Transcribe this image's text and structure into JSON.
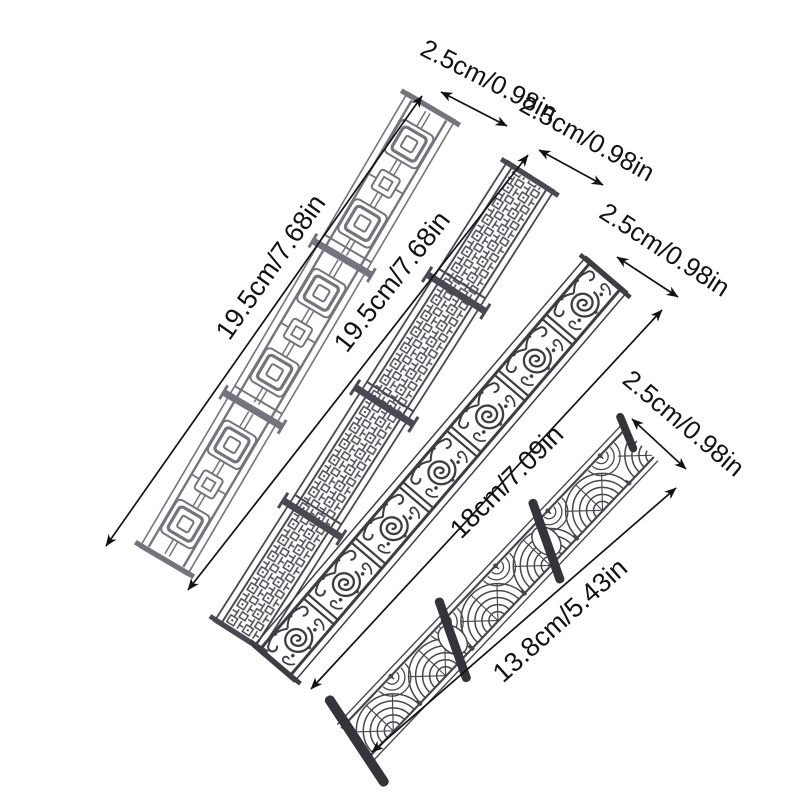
{
  "figure": {
    "type": "product-dimension-diagram",
    "background_color": "#ffffff",
    "annotation": {
      "color": "#121212"
    },
    "strips": [
      {
        "name": "fence-style-1",
        "pattern": "concentric-square lattice railing",
        "length_label": "19.5cm/7.68in",
        "width_label": "2.5cm/0.98in",
        "color": "#76737e"
      },
      {
        "name": "fence-style-2",
        "pattern": "dense fretwork lattice railing",
        "length_label": "19.5cm/7.68in",
        "width_label": "2.5cm/0.98in",
        "color": "#4a4852"
      },
      {
        "name": "fence-style-3",
        "pattern": "scroll wrought-iron railing",
        "length_label": "18cm/7.09in",
        "width_label": "2.5cm/0.98in",
        "color": "#3e3c44"
      },
      {
        "name": "fence-style-4",
        "pattern": "fan arc railing",
        "length_label": "13.8cm/5.43in",
        "width_label": "2.5cm/0.98in",
        "color": "#47454d",
        "post_color": "#35343b"
      }
    ]
  }
}
